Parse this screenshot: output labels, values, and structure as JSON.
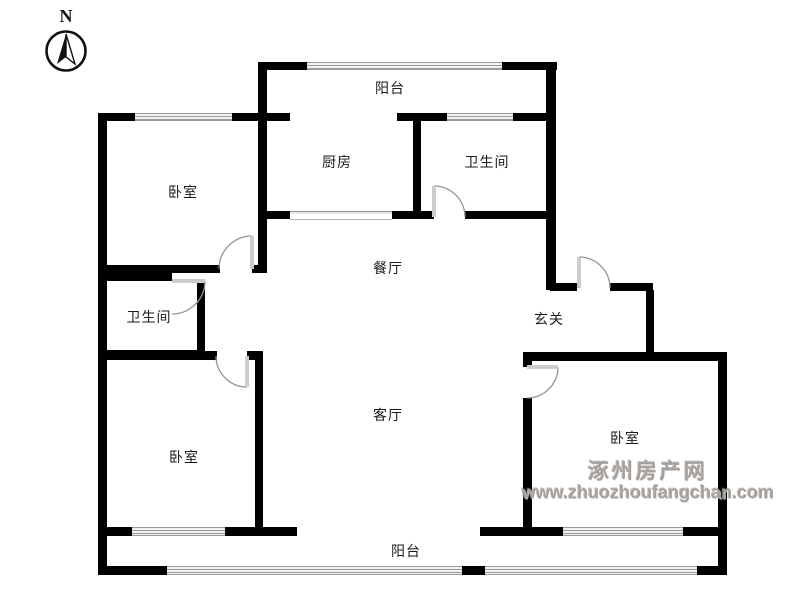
{
  "page": {
    "background": "#ffffff"
  },
  "compass": {
    "label": "N"
  },
  "watermark": {
    "site_name": "涿州房产网",
    "site_url": "www.zhuozhoufangchan.com",
    "color": "#a5a09c"
  },
  "floorplan": {
    "wall_color": "#000000",
    "rooms": [
      {
        "id": "balcony-top",
        "label": "阳台",
        "x": 390,
        "y": 88
      },
      {
        "id": "kitchen",
        "label": "厨房",
        "x": 337,
        "y": 162
      },
      {
        "id": "bathroom-top",
        "label": "卫生间",
        "x": 487,
        "y": 162
      },
      {
        "id": "bedroom-top-left",
        "label": "卧室",
        "x": 183,
        "y": 192
      },
      {
        "id": "dining-room",
        "label": "餐厅",
        "x": 388,
        "y": 268
      },
      {
        "id": "bathroom-left",
        "label": "卫生间",
        "x": 149,
        "y": 317
      },
      {
        "id": "entrance-hall",
        "label": "玄关",
        "x": 549,
        "y": 319
      },
      {
        "id": "living-room",
        "label": "客厅",
        "x": 388,
        "y": 415
      },
      {
        "id": "bedroom-bottom-left",
        "label": "卧室",
        "x": 184,
        "y": 457
      },
      {
        "id": "bedroom-bottom-right",
        "label": "卧室",
        "x": 625,
        "y": 438
      },
      {
        "id": "balcony-bottom",
        "label": "阳台",
        "x": 406,
        "y": 551
      }
    ],
    "walls": [
      [
        98,
        113,
        9,
        462
      ],
      [
        258,
        62,
        9,
        211
      ],
      [
        413,
        121,
        8,
        97
      ],
      [
        546,
        62,
        10,
        228
      ],
      [
        197,
        281,
        8,
        77
      ],
      [
        646,
        290,
        8,
        68
      ],
      [
        523,
        358,
        9,
        9
      ],
      [
        523,
        398,
        9,
        137
      ],
      [
        255,
        360,
        8,
        175
      ],
      [
        718,
        352,
        9,
        223
      ],
      [
        258,
        62,
        49,
        8
      ],
      [
        502,
        62,
        55,
        8
      ],
      [
        98,
        113,
        37,
        8
      ],
      [
        232,
        113,
        58,
        8
      ],
      [
        397,
        113,
        50,
        8
      ],
      [
        513,
        113,
        43,
        8
      ],
      [
        258,
        211,
        32,
        8
      ],
      [
        392,
        211,
        42,
        8
      ],
      [
        465,
        211,
        86,
        8
      ],
      [
        98,
        265,
        122,
        8
      ],
      [
        252,
        265,
        14,
        8
      ],
      [
        98,
        273,
        74,
        8
      ],
      [
        98,
        351,
        119,
        9
      ],
      [
        247,
        351,
        16,
        9
      ],
      [
        98,
        350,
        107,
        8
      ],
      [
        550,
        283,
        27,
        8
      ],
      [
        610,
        283,
        43,
        8
      ],
      [
        523,
        352,
        204,
        9
      ],
      [
        98,
        527,
        34,
        9
      ],
      [
        225,
        527,
        72,
        9
      ],
      [
        480,
        527,
        83,
        9
      ],
      [
        683,
        527,
        44,
        9
      ],
      [
        100,
        566,
        67,
        9
      ],
      [
        462,
        566,
        23,
        9
      ],
      [
        697,
        566,
        30,
        9
      ]
    ],
    "windows": [
      [
        307,
        62,
        195,
        8
      ],
      [
        135,
        113,
        97,
        8
      ],
      [
        447,
        113,
        66,
        8
      ],
      [
        132,
        527,
        93,
        9
      ],
      [
        563,
        527,
        120,
        9
      ],
      [
        167,
        566,
        295,
        9
      ],
      [
        485,
        566,
        212,
        9
      ]
    ],
    "sliders": [
      [
        290,
        211,
        102,
        7
      ]
    ],
    "doors": [
      {
        "hx": 252,
        "hy": 269,
        "tx": 252,
        "ty": 236,
        "ex": 219,
        "ey": 269,
        "r": 33,
        "sweep": 0
      },
      {
        "hx": 172,
        "hy": 281,
        "tx": 205,
        "ty": 281,
        "ex": 172,
        "ey": 314,
        "r": 33,
        "sweep": 1
      },
      {
        "hx": 434,
        "hy": 217,
        "tx": 434,
        "ty": 186,
        "ex": 465,
        "ey": 217,
        "r": 31,
        "sweep": 1
      },
      {
        "hx": 579,
        "hy": 288,
        "tx": 579,
        "ty": 257,
        "ex": 610,
        "ey": 288,
        "r": 31,
        "sweep": 1
      },
      {
        "hx": 527,
        "hy": 367,
        "tx": 558,
        "ty": 367,
        "ex": 527,
        "ey": 398,
        "r": 31,
        "sweep": 1
      },
      {
        "hx": 247,
        "hy": 356,
        "tx": 247,
        "ty": 387,
        "ex": 216,
        "ey": 356,
        "r": 31,
        "sweep": 1
      }
    ]
  }
}
